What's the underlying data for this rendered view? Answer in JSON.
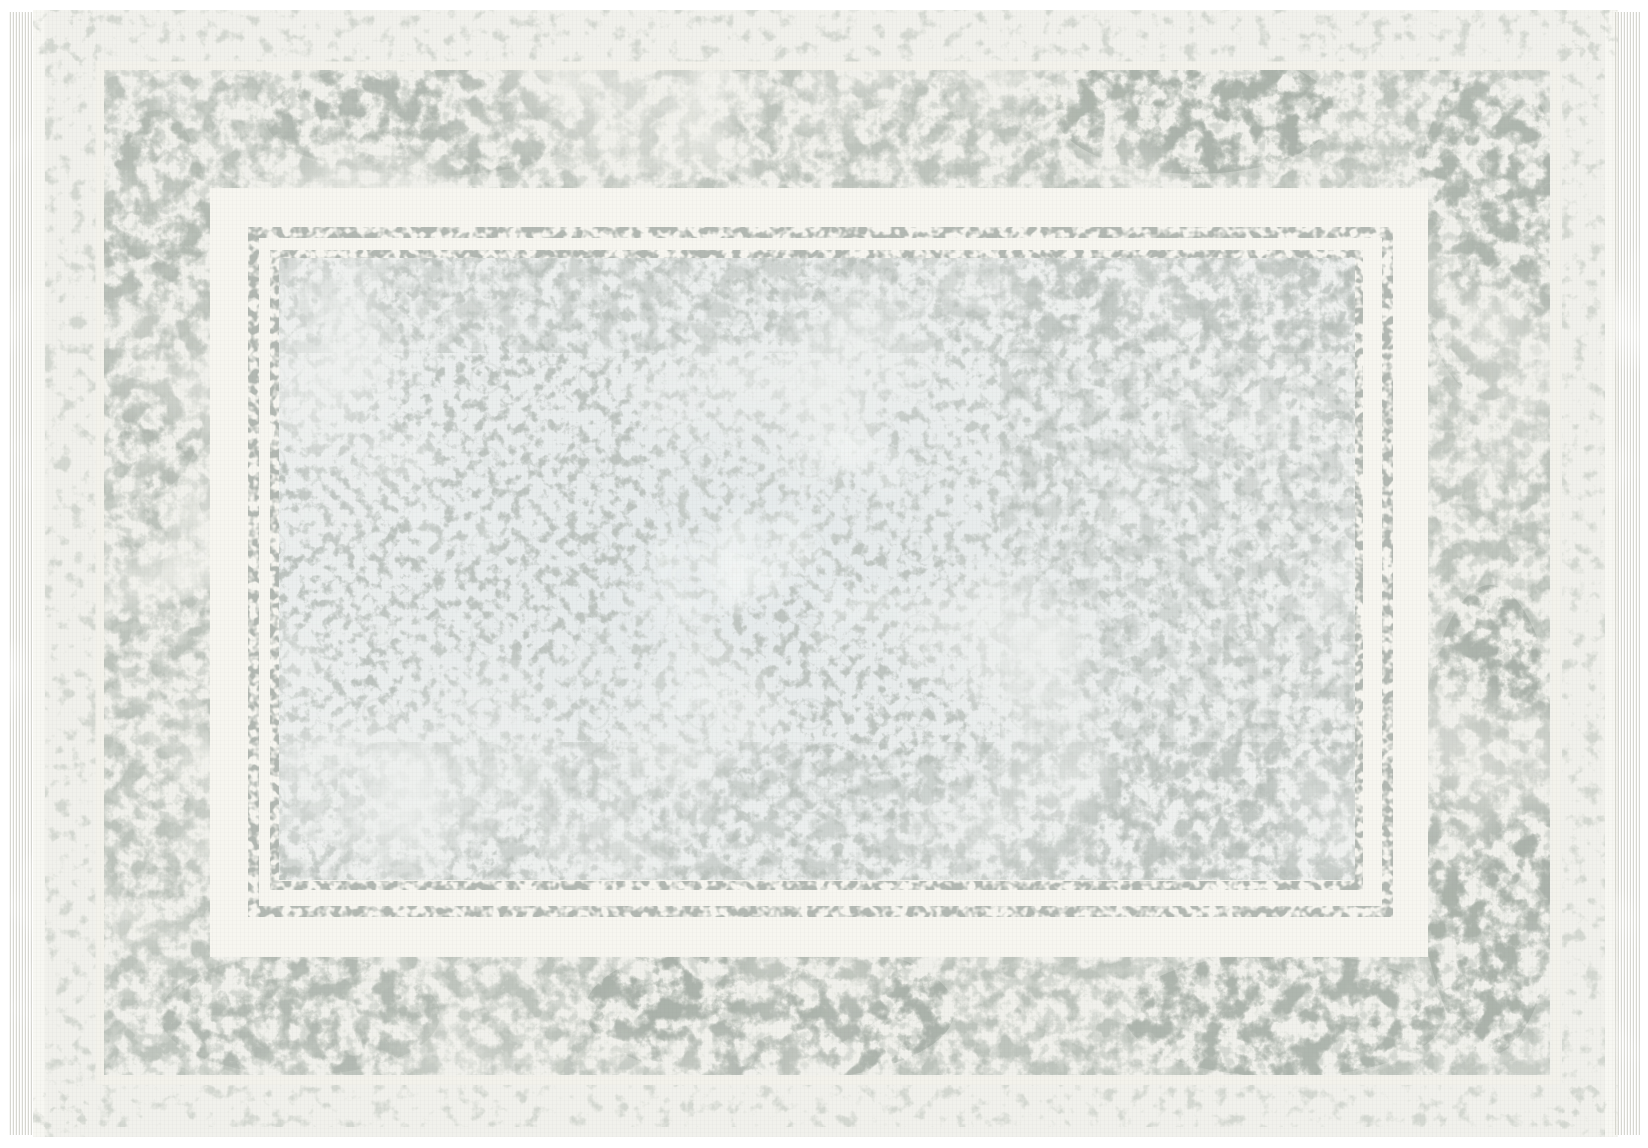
{
  "image": {
    "type": "product-photograph",
    "subject": "Vintage-style distressed (erased oriental) area rug, landscape orientation, photographed flat from above on a white background",
    "text_content": "none — the photograph contains no text, numbers or UI elements",
    "palette": {
      "canvas_white": "#ffffff",
      "rug_base": "#f1f1ec",
      "selvage_white": "#f7f7f2",
      "light_strip_gray": "#d5d9d2",
      "cream_line": "#f3f2eb",
      "border_gray": "#bfc5be",
      "border_gray_soft": "#cdd2cb",
      "border_dark_gray": "#a9b1a9",
      "wash_white": "#f3f3ee",
      "frame_white": "#f7f6f0",
      "pinstripe_gray": "#b3b9b3",
      "field_base": "#eff1ef",
      "field_tint": "#dce4e8",
      "field_speckle": "#c4cac6",
      "field_dense": "#b6bdb8",
      "pool_white": "#f3f6f5",
      "fringe_strand": "#d2d2cb",
      "weave_gray": "#6e786e"
    }
  },
  "rug": {
    "fringe": {
      "sides": [
        "left",
        "right"
      ],
      "style": "short pale thread fringe on the two short ends"
    },
    "bands_outer_to_inner": [
      {
        "name": "selvage",
        "desc": "bright white bound edge strip"
      },
      {
        "name": "outer-light-band",
        "desc": "pale washed gray textured strip"
      },
      {
        "name": "cream-guard-line",
        "desc": "thin off-white concentric line"
      },
      {
        "name": "main-border",
        "desc": "wide heavily eroded gray border with darker patches (top-right, right side, bottom center) and washed-out areas (left side, top center)"
      },
      {
        "name": "white-frame",
        "desc": "wide bright cream frame band"
      },
      {
        "name": "double-pinstripe",
        "desc": "two thin broken speckled gray rectangle lines"
      },
      {
        "name": "inner-field",
        "desc": "very pale cool blue-gray field covered in faded fine gray ornament speckle, denser along top, bottom and right, with pale eroded pools in the center"
      }
    ]
  }
}
